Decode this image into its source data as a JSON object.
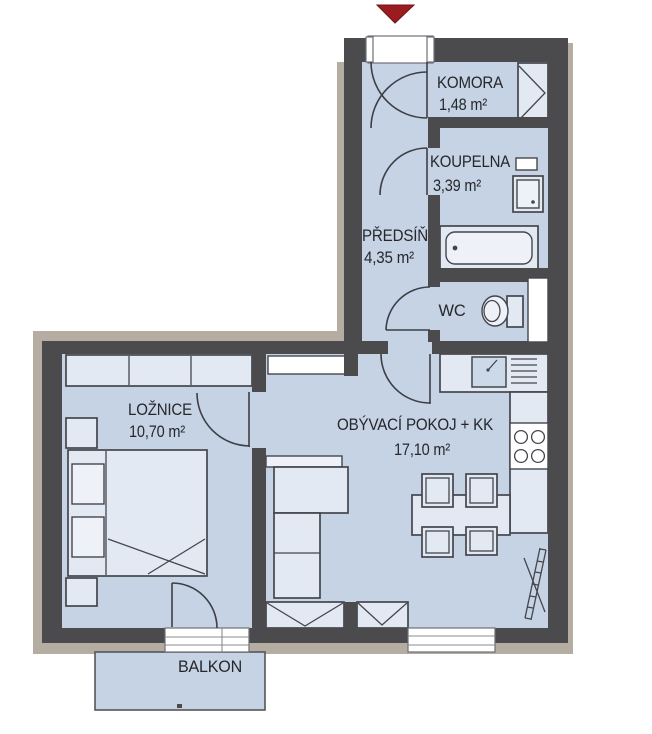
{
  "plan_title": "Apartment floor plan",
  "rooms": [
    {
      "id": "komora",
      "name": "KOMORA",
      "area": "1,48 m²"
    },
    {
      "id": "koupelna",
      "name": "KOUPELNA",
      "area": "3,39 m²"
    },
    {
      "id": "predsin",
      "name": "PŘEDSÍŇ",
      "area": "4,35 m²"
    },
    {
      "id": "wc",
      "name": "WC",
      "area": ""
    },
    {
      "id": "loznice",
      "name": "LOŽNICE",
      "area": "10,70 m²"
    },
    {
      "id": "obyvaci",
      "name": "OBÝVACÍ POKOJ + KK",
      "area": "17,10 m²"
    },
    {
      "id": "balkon",
      "name": "BALKON",
      "area": ""
    }
  ],
  "colors": {
    "wall": "#4b4b4d",
    "floor": "#c5d3e5",
    "furn": "#e2e9f3",
    "furnlight": "#eef2f8",
    "beige": "#b5ada2",
    "arrow": "#9b1c20",
    "line": "#44464c",
    "text": "#26272b",
    "white": "#ffffff"
  }
}
